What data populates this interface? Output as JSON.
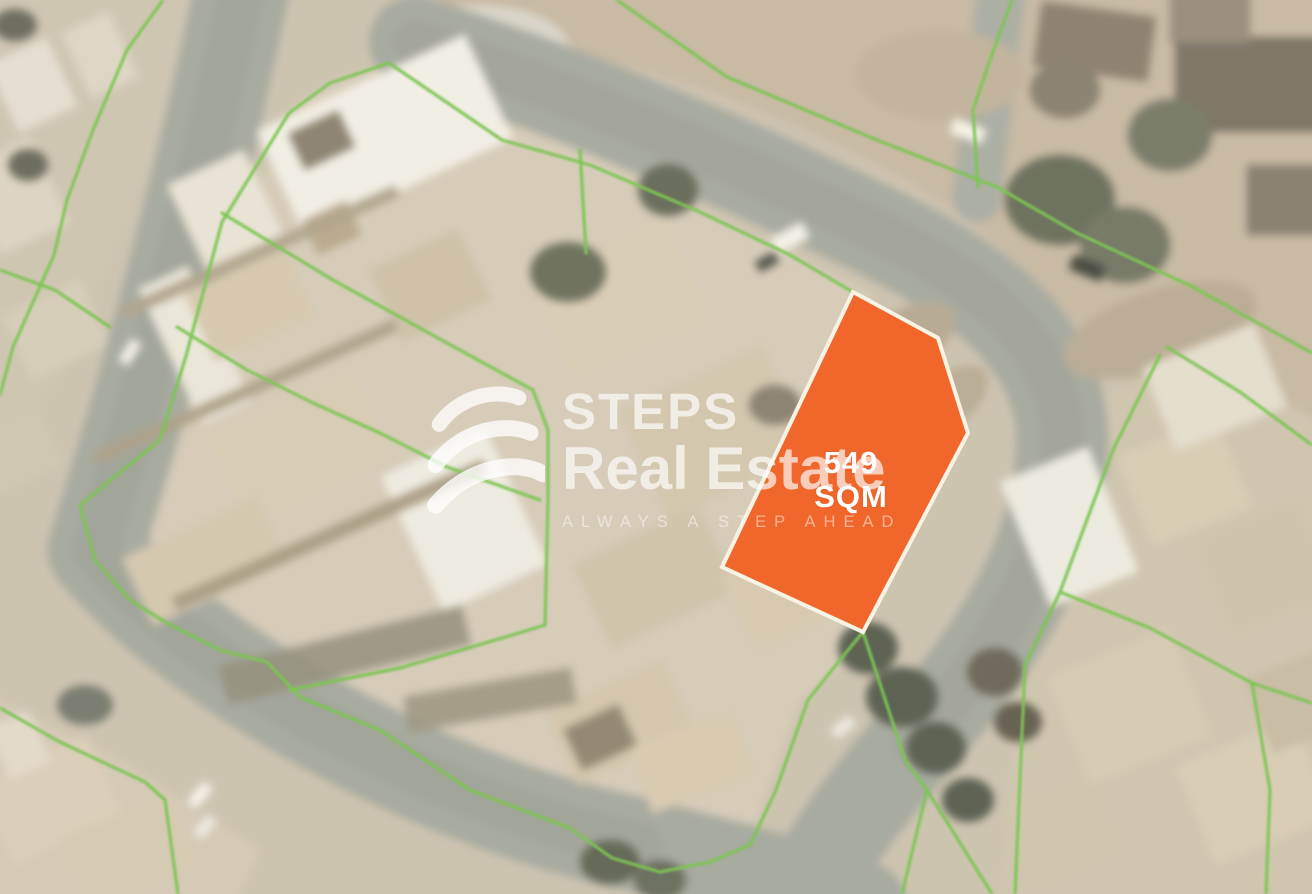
{
  "map": {
    "type": "satellite-aerial",
    "highlighted_plot": {
      "area_label": "549 SQM",
      "polygon_points": "853,292 938,338 968,433 863,632 722,567"
    }
  },
  "watermark": {
    "brand_line1": "STEPS",
    "brand_line2": "Real Estate",
    "tagline": "ALWAYS A STEP AHEAD"
  },
  "colors": {
    "plot-fill": "#F0662B",
    "plot-border": "#F8F3E4",
    "plot-label": "#FFFFFF",
    "parcel-line": "#7DC554",
    "watermark": "#FFFFFF"
  }
}
